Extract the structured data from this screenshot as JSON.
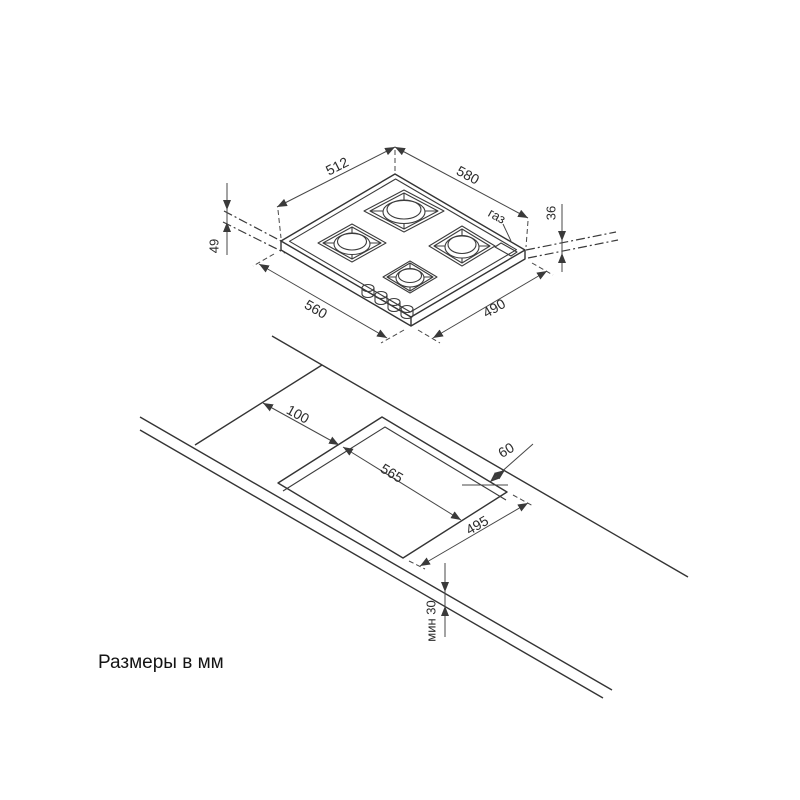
{
  "drawing": {
    "units_note": "Размеры в мм",
    "hob_view": {
      "glass_width": "512",
      "glass_depth": "580",
      "body_width": "560",
      "body_depth": "490",
      "height_below_worktop": "49",
      "height_above_worktop": "36",
      "gas_label": "газ"
    },
    "cutout_view": {
      "side_offset": "100",
      "back_offset": "60",
      "cutout_width": "565",
      "cutout_depth": "495",
      "front_min_distance": "мин 30"
    }
  }
}
